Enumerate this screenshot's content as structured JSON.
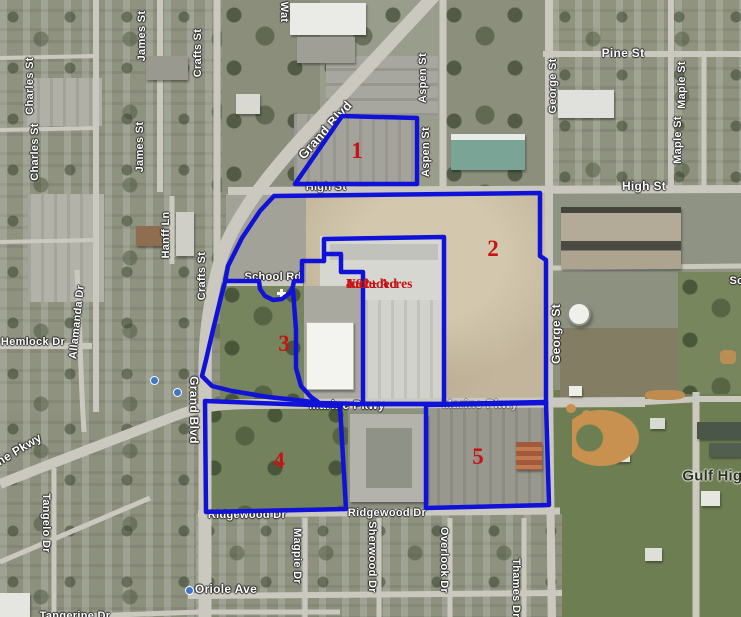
{
  "title": "Aerial parcel map",
  "colors": {
    "parcel_outline": "#1012d8",
    "annotation_red": "#c61313",
    "street_label": "#ffffff"
  },
  "annotation": {
    "line1": "4.92± Acres",
    "line2": "Not",
    "line3": "Included"
  },
  "parcel_numbers": [
    {
      "n": "1",
      "x": 357,
      "y": 151
    },
    {
      "n": "2",
      "x": 493,
      "y": 249
    },
    {
      "n": "3",
      "x": 284,
      "y": 344
    },
    {
      "n": "4",
      "x": 279,
      "y": 461
    },
    {
      "n": "5",
      "x": 478,
      "y": 457
    }
  ],
  "street_labels": [
    {
      "text": "Charles St",
      "x": 30,
      "y": 86,
      "rot": -90
    },
    {
      "text": "Charles St",
      "x": 35,
      "y": 152,
      "rot": -90
    },
    {
      "text": "James St",
      "x": 142,
      "y": 36,
      "rot": -90
    },
    {
      "text": "James St",
      "x": 140,
      "y": 147,
      "rot": -90
    },
    {
      "text": "Crafts St",
      "x": 198,
      "y": 53,
      "rot": -90
    },
    {
      "text": "Crafts St",
      "x": 202,
      "y": 276,
      "rot": -90
    },
    {
      "text": "Hanff Ln",
      "x": 166,
      "y": 235,
      "rot": -90
    },
    {
      "text": "Allamanda Dr",
      "x": 77,
      "y": 322,
      "rot": -84
    },
    {
      "text": "Hemlock Dr",
      "x": 33,
      "y": 342,
      "rot": 0
    },
    {
      "text": "Grand Blvd",
      "x": 325,
      "y": 130,
      "rot": -48,
      "size": 13
    },
    {
      "text": "Grand Blvd",
      "x": 194,
      "y": 410,
      "rot": 90,
      "size": 12
    },
    {
      "text": "Wat",
      "x": 284,
      "y": 12,
      "rot": 90
    },
    {
      "text": "Aspen St",
      "x": 423,
      "y": 78,
      "rot": -90
    },
    {
      "text": "Aspen St",
      "x": 426,
      "y": 152,
      "rot": -90
    },
    {
      "text": "Pine St",
      "x": 623,
      "y": 53,
      "rot": 0,
      "size": 12
    },
    {
      "text": "George St",
      "x": 553,
      "y": 86,
      "rot": -90
    },
    {
      "text": "George St",
      "x": 556,
      "y": 334,
      "rot": -90,
      "size": 12
    },
    {
      "text": "Maple St",
      "x": 682,
      "y": 85,
      "rot": -90
    },
    {
      "text": "Maple St",
      "x": 678,
      "y": 140,
      "rot": -90
    },
    {
      "text": "High St",
      "x": 326,
      "y": 187,
      "rot": 0
    },
    {
      "text": "High St",
      "x": 644,
      "y": 186,
      "rot": 0,
      "size": 12
    },
    {
      "text": "School Rd",
      "x": 273,
      "y": 277,
      "rot": 0
    },
    {
      "text": "Marine Pkwy",
      "x": 347,
      "y": 405,
      "rot": 0,
      "size": 12
    },
    {
      "text": "Marine Pkwy",
      "x": 480,
      "y": 404,
      "rot": 0,
      "size": 12,
      "opacity": 0.5
    },
    {
      "text": "Marine Pkwy",
      "x": 8,
      "y": 456,
      "rot": -31,
      "size": 12
    },
    {
      "text": "Ridgewood Dr",
      "x": 247,
      "y": 515,
      "rot": 0
    },
    {
      "text": "Ridgewood Dr",
      "x": 387,
      "y": 513,
      "rot": 0
    },
    {
      "text": "Oriole Ave",
      "x": 226,
      "y": 589,
      "rot": 0,
      "size": 12
    },
    {
      "text": "Magpie Dr",
      "x": 297,
      "y": 556,
      "rot": 90
    },
    {
      "text": "Sherwood Dr",
      "x": 372,
      "y": 557,
      "rot": 90
    },
    {
      "text": "Overlook Dr",
      "x": 444,
      "y": 560,
      "rot": 90
    },
    {
      "text": "Thames Dr",
      "x": 516,
      "y": 588,
      "rot": 90
    },
    {
      "text": "Tangelo Dr",
      "x": 46,
      "y": 523,
      "rot": 90
    },
    {
      "text": "Gulf High",
      "x": 717,
      "y": 476,
      "rot": 0,
      "dark": true
    },
    {
      "text": "Tangerine Dr",
      "x": 75,
      "y": 616,
      "rot": 0
    },
    {
      "text": "Sch",
      "x": 740,
      "y": 281,
      "rot": 0
    }
  ]
}
